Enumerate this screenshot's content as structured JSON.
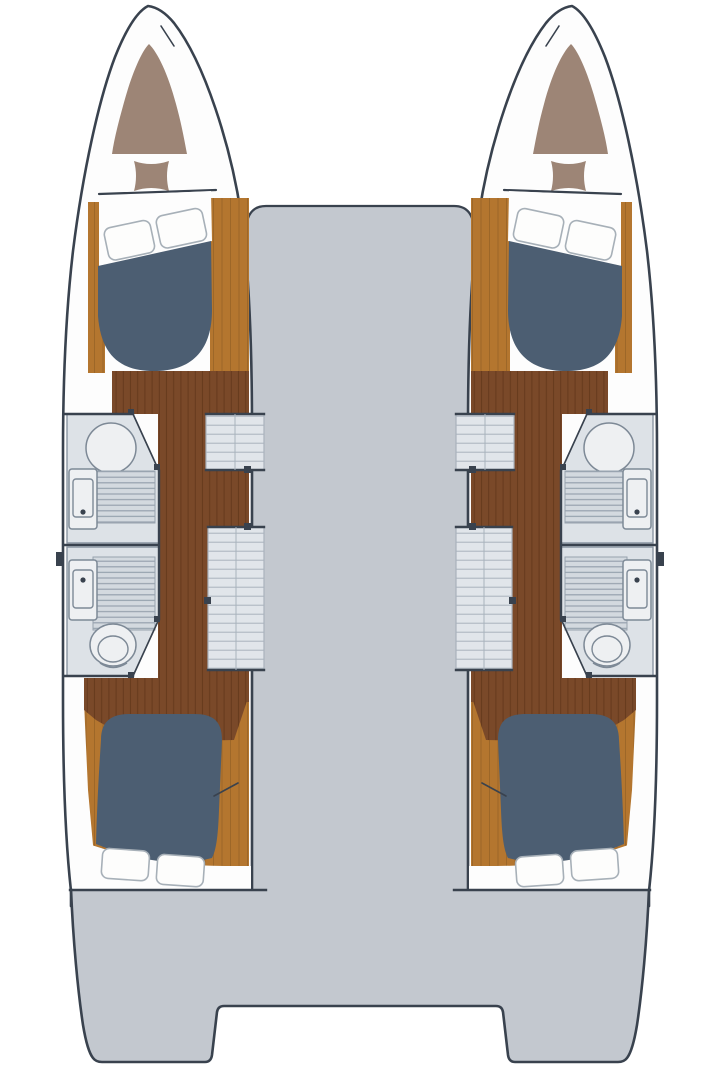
{
  "diagram": {
    "type": "floor-plan",
    "subject": "catamaran interior deck plan, top-down view, symmetrical twin hulls",
    "components": [
      {
        "id": "port-hull-plan",
        "label": "port hull (left)"
      },
      {
        "id": "starboard-hull-plan",
        "label": "starboard hull (right, mirrored)"
      },
      {
        "id": "forepeak-locker",
        "label": "bow forepeak locker with cushion"
      },
      {
        "id": "forward-berth",
        "label": "forward double berth with two pillows"
      },
      {
        "id": "forward-head",
        "label": "forward bathroom: shower, grate floor, washbasin"
      },
      {
        "id": "aft-head",
        "label": "aft bathroom: washbasin, grate floor, toilet"
      },
      {
        "id": "wardrobe-cabinet",
        "label": "inboard wardrobe / storage cabinets"
      },
      {
        "id": "corridor-floor",
        "label": "wood companionway corridor along inboard side"
      },
      {
        "id": "aft-berth",
        "label": "aft double berth with two pillows"
      },
      {
        "id": "saloon-deck",
        "label": "central bridgedeck / saloon floor"
      },
      {
        "id": "aft-deck",
        "label": "aft deck with twin transom steps"
      }
    ]
  },
  "palette": {
    "background": "#ffffff",
    "outline": "#39424e",
    "deck": "#c3c8cf",
    "hull": "#fdfdfd",
    "wallLine": "#8a95a2",
    "bathFloor": "#dde2e7",
    "bathFixture": "#eef0f2",
    "fixtureLine": "#7d8996",
    "grateFill": "#d3d9df",
    "grateLine": "#97a2ae",
    "cabinet": "#e1e5ea",
    "cabinetLine": "#a9b2bc",
    "bed": "#4c5e72",
    "pillowFill": "#fdfdfc",
    "pillowStroke": "#a7b0b8",
    "woodLight": "#b4762f",
    "woodLightLine": "#8a5a22",
    "woodDark": "#7a4929",
    "woodDarkLine": "#5c3418",
    "forepeak": "#9d8576"
  }
}
